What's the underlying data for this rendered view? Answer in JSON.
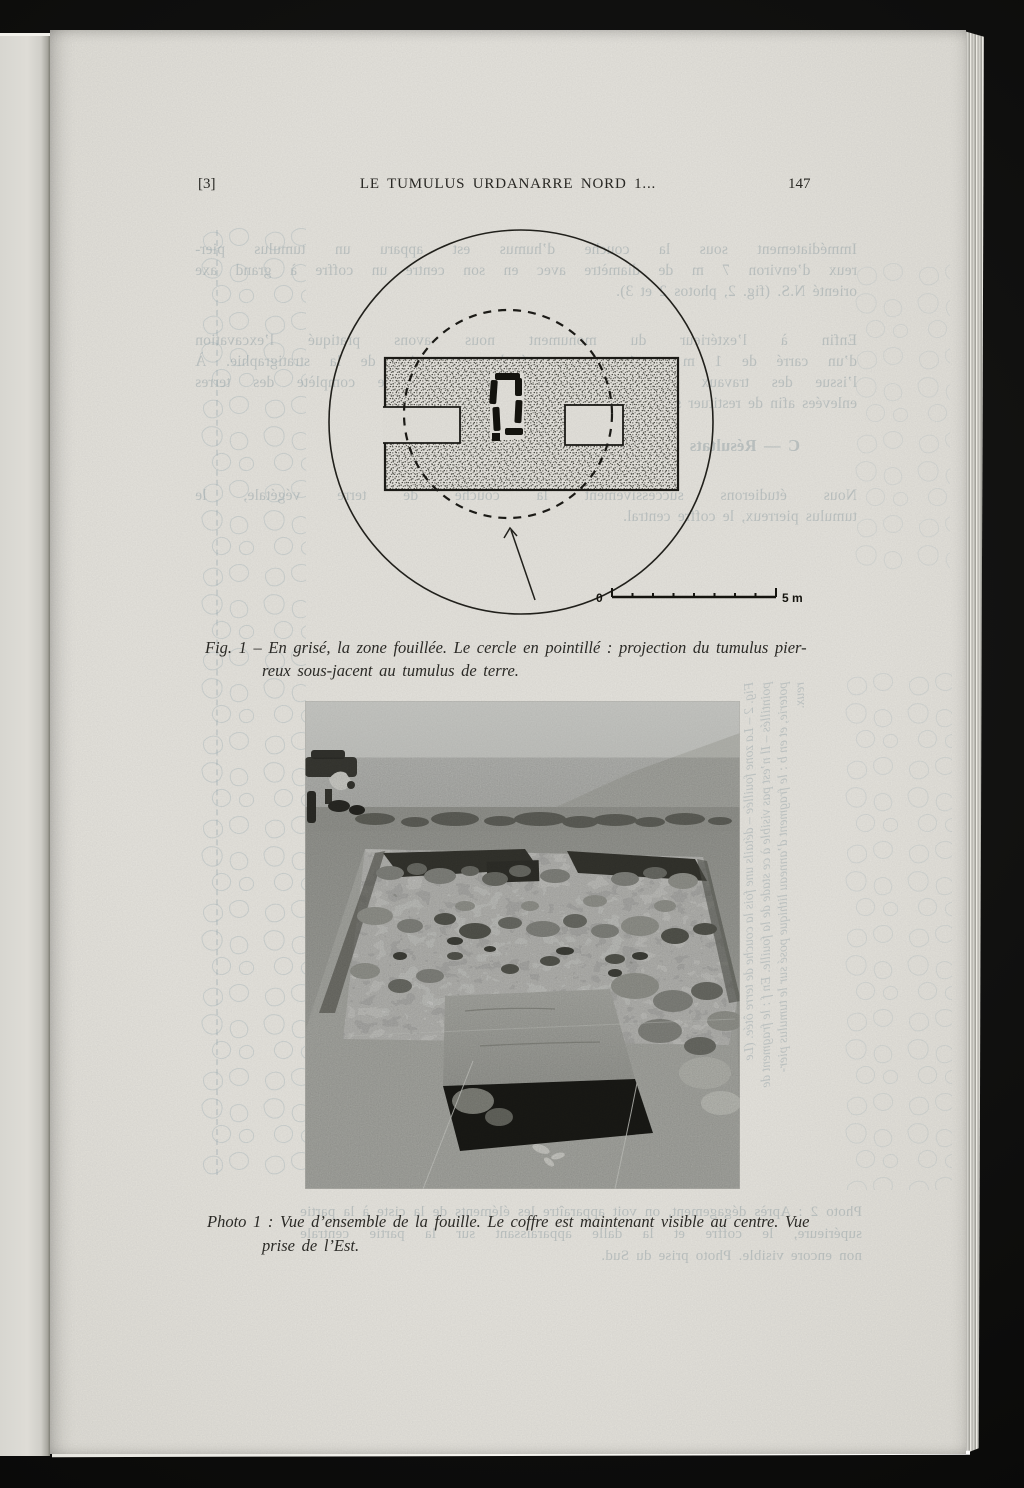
{
  "header": {
    "index_marker": "[3]",
    "running_title": "LE TUMULUS URDANARRE NORD 1...",
    "page_number": "147"
  },
  "figure1": {
    "scale_zero": "0",
    "scale_end": "5 m",
    "caption_line1": "Fig. 1 – En grisé, la zone fouillée. Le cercle en pointillé : projection du tumulus pier-",
    "caption_line2": "reux sous-jacent au tumulus de terre."
  },
  "photo1": {
    "caption_line1": "Photo 1 : Vue d’ensemble de la fouille. Le coffre est maintenant visible au centre. Vue",
    "caption_line2": "prise de l’Est."
  },
  "bleedthrough": {
    "para1_line1": "Immédiatement sous la couche d’humus est apparu un tumulus pier-",
    "para1_line2": "reux d’environ 7 m de diamètre avec en son centre un coffre à grand axe",
    "para1_line3": "orienté N.S. (fig. 2, photos 2 et 3).",
    "para2_line1": "Enfin à l’extérieur du monument nous avons pratiqué l’excavation",
    "para2_line2": "d’un carré de 1 m x 1 m pour étude comparative de la stratigraphie. À",
    "para2_line3": "l’issue des travaux le monument sera remis en place complète des terres",
    "para2_line4": "enlevées afin de restituer son aspect extérieur primitif.",
    "heading": "C — Résultats",
    "para3_line1": "Nous étudierons successivement la couche de terre végétale, le",
    "para3_line2": "tumulus pierreux, le coffre central.",
    "vertical_line1": "Fig. 2 – La zone fouillée – détails une fois la couche de terre ôtée. (Le",
    "vertical_line2": "pointillés – Il n’est pas visible à ce stade de la fouille. En f : le fragment de",
    "vertical_line3": "poterie, et en b : le fragment d’anneau lithique posé sur le tumulus pier-",
    "vertical_line4": "reux.",
    "photo2_line1": "Photo 2 : Après dégagement, on voit apparaître les éléments de la ciste à la partie",
    "photo2_line2": "supérieure, le coffre et la dalle apparaissant sur la partie centrale",
    "photo2_line3": "non encore visible. Photo prise du Sud."
  }
}
